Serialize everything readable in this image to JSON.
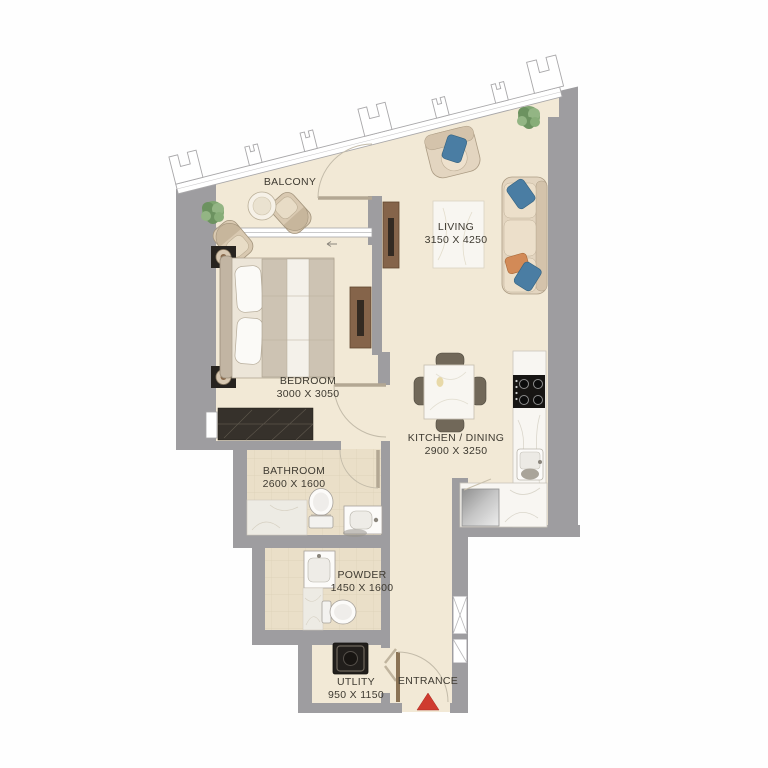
{
  "plan": {
    "type": "apartment-floor-plan",
    "rooms": {
      "balcony": {
        "label": "BALCONY",
        "dims": ""
      },
      "living": {
        "label": "LIVING",
        "dims": "3150 X 4250"
      },
      "bedroom": {
        "label": "BEDROOM",
        "dims": "3000 X 3050"
      },
      "kitchen_dining": {
        "label": "KITCHEN / DINING",
        "dims": "2900 X 3250"
      },
      "bathroom": {
        "label": "BATHROOM",
        "dims": "2600 X 1600"
      },
      "powder": {
        "label": "POWDER",
        "dims": "1450 X 1600"
      },
      "utility": {
        "label": "UTLITY",
        "dims": "950 X 1150"
      },
      "entrance": {
        "label": "ENTRANCE",
        "dims": ""
      }
    },
    "colors": {
      "wall": "#9e9da0",
      "floor": "#f2e9d6",
      "tile": "#eadfc8",
      "wood": "#85644a",
      "upholstery": "#e3d5c0",
      "pillow-blue": "#4a7da3",
      "pillow-orange": "#d28a57",
      "plant": "#7fa571",
      "rug-dark": "#36312b",
      "entrance-arrow": "#cf3b2f",
      "label-text": "#3e3a31"
    }
  }
}
